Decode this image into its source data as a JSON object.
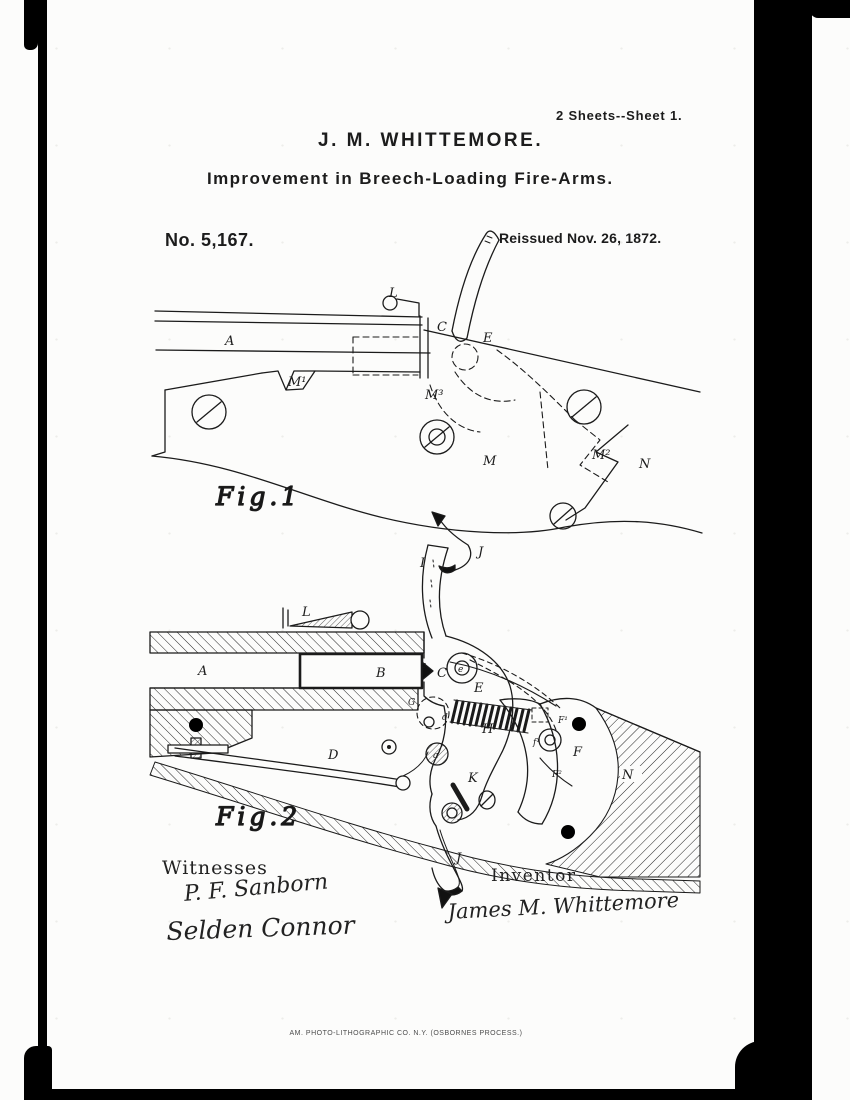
{
  "page": {
    "sheet_label": "2 Sheets--Sheet 1.",
    "inventor_heading": "J. M. WHITTEMORE.",
    "invention_title": "Improvement in Breech-Loading Fire-Arms.",
    "patent_number": "No. 5,167.",
    "reissue_date": "Reissued Nov. 26, 1872.",
    "lithographer_line": "AM. PHOTO-LITHOGRAPHIC CO. N.Y. (OSBORNES PROCESS.)"
  },
  "figures": {
    "fig1": {
      "caption": "Fig.1",
      "labels": {
        "L": "L",
        "A": "A",
        "C": "C",
        "E": "E",
        "M1": "M¹",
        "M3": "M³",
        "M": "M",
        "M2": "M²",
        "N": "N",
        "J": "J"
      }
    },
    "fig2": {
      "caption": "Fig.2",
      "labels": {
        "I": "I",
        "L": "L",
        "A": "A",
        "B": "B",
        "c": "c",
        "C": "C",
        "G": "G",
        "d": "d",
        "e": "e",
        "E": "E",
        "H": "H",
        "F1": "F¹",
        "f1": "f¹",
        "F": "F",
        "F2": "F²",
        "K": "K",
        "a": "a",
        "D": "D",
        "N": "N",
        "J": "J"
      }
    }
  },
  "signatures": {
    "witnesses_heading": "Witnesses",
    "witness1": "P. F. Sanborn",
    "witness2": "Selden Connor",
    "inventor_heading": "Inventor",
    "inventor_signature": "James M. Whittemore"
  }
}
